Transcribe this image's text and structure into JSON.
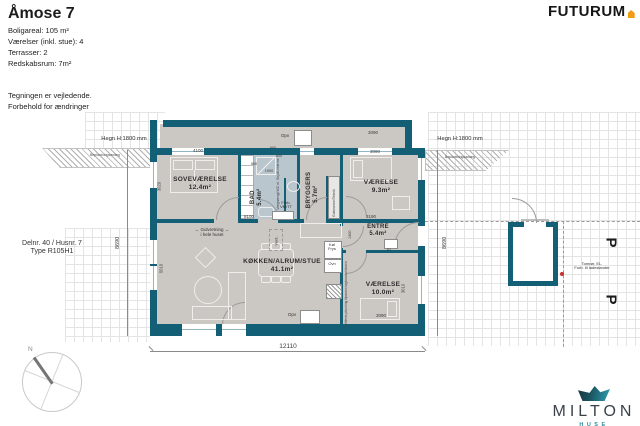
{
  "header": {
    "title": "Åmose 7",
    "specs": [
      "Boligareal:  105 m²",
      "Værelser (inkl. stue): 4",
      "Terrasser: 2",
      "Redskabsrum: 7m²"
    ],
    "notes": [
      "Tegningen er vejledende.",
      "Forbehold for ændringer"
    ]
  },
  "brand": {
    "futurum": "FUTURUM"
  },
  "milton": {
    "name": "MILTON",
    "sub": "HUSE"
  },
  "plot_info": {
    "line1": "Delnr. 40 / Husnr. 7",
    "line2": "Type R105H1"
  },
  "compass": {
    "north": "N"
  },
  "site": {
    "hegn_left": "Hegn H:1800 mm",
    "hegn_right": "Hegn H:1800 mm",
    "hatch_left": "Beplantningsanlæg",
    "hatch_right": "Beplantningsanlæg",
    "parking_1": "P",
    "parking_2": "P",
    "charger_note": [
      "Tomrør, EL.",
      "Forb. til ladestander"
    ]
  },
  "rooms": {
    "sovevaerelse": {
      "name": "SOVEVÆRELSE",
      "area": "12.4m²"
    },
    "bad": {
      "name": "BAD",
      "area": "5.4m²"
    },
    "bryggers": {
      "name": "BRYGGERS",
      "area": "5.7m²"
    },
    "vaerelse1": {
      "name": "VÆRELSE",
      "area": "9.3m²"
    },
    "entre": {
      "name": "ENTRE",
      "area": "5.4m²"
    },
    "stue": {
      "name": "KØKKEN/ALRUM/STUE",
      "area": "41.1m²"
    },
    "vaerelse2": {
      "name": "VÆRELSE",
      "area": "10.0m²"
    }
  },
  "annotations": {
    "arrow_left": "←",
    "arrow_right": "→",
    "gulvretning1": "Gulvretning",
    "gulvretning2": "i hele huset",
    "opv_top": "Opv",
    "opv_kitchen": "Opv",
    "vent": "Vent.",
    "koel": "Køl",
    "frys": "Frys",
    "ovn": "Ovn",
    "el": "EL.",
    "forb_line1": "Forb.",
    "forb_line2": "VM/TT",
    "wc_note": "Væghængt WC el. Skjult cisterne",
    "teknik": "Gulvvarme/Teknik",
    "loftlem": "Loftlems placering tilpasses tagkonstruktionen"
  },
  "dimensions": {
    "total_width": "12110",
    "left_height": "8690",
    "right_height": "8690",
    "sove_width": "4100",
    "terrace_right": "3090",
    "vaer1_width": "3090",
    "stue_width": "8100",
    "entre_width": "3190",
    "bad_600": "600",
    "bad_800": "800",
    "bad_500": "500",
    "bad_1900": "1900",
    "entre_depth": "1300",
    "stue_height": "5010",
    "sove_height": "3020",
    "vaer2_height": "3010",
    "vaer2_width": "3090"
  },
  "colors": {
    "wall_teal": "#135f75",
    "floor_gray": "#cbc7c3",
    "bath_blue": "#b9c6ce",
    "futurum_orange": "#f39c12",
    "milton_teal": "#2f8d9b",
    "charger_dot_red": "#c2332b"
  }
}
